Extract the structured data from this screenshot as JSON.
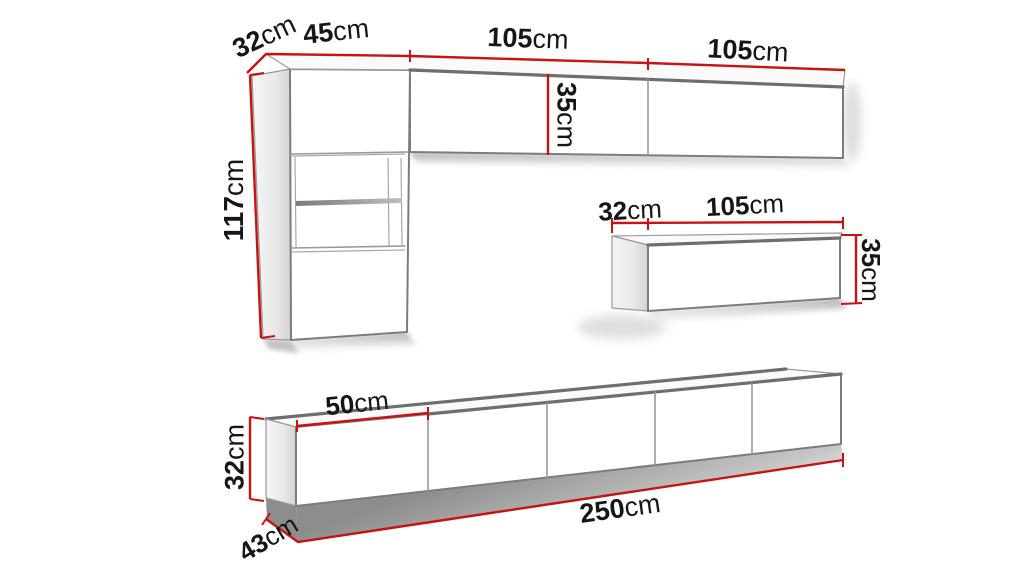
{
  "diagram": {
    "type": "furniture-wall-unit-dimension-diagram",
    "unit": "cm",
    "colors": {
      "dimension_line": "#c91212",
      "outline": "#7c7c7c",
      "label_text": "#161616",
      "background": "#ffffff"
    },
    "labels": {
      "upper_depth": {
        "value": "32",
        "unit": "cm"
      },
      "tall_cabinet_width": {
        "value": "45",
        "unit": "cm"
      },
      "upper_cabinet_1_width": {
        "value": "105",
        "unit": "cm"
      },
      "upper_cabinet_2_width": {
        "value": "105",
        "unit": "cm"
      },
      "tall_cabinet_height": {
        "value": "117",
        "unit": "cm"
      },
      "upper_cabinet_height": {
        "value": "35",
        "unit": "cm"
      },
      "wall_cabinet_depth": {
        "value": "32",
        "unit": "cm"
      },
      "wall_cabinet_width": {
        "value": "105",
        "unit": "cm"
      },
      "wall_cabinet_height": {
        "value": "35",
        "unit": "cm"
      },
      "tv_stand_door_width": {
        "value": "50",
        "unit": "cm"
      },
      "tv_stand_height": {
        "value": "32",
        "unit": "cm"
      },
      "tv_stand_depth": {
        "value": "43",
        "unit": "cm"
      },
      "tv_stand_total_width": {
        "value": "250",
        "unit": "cm"
      }
    }
  }
}
